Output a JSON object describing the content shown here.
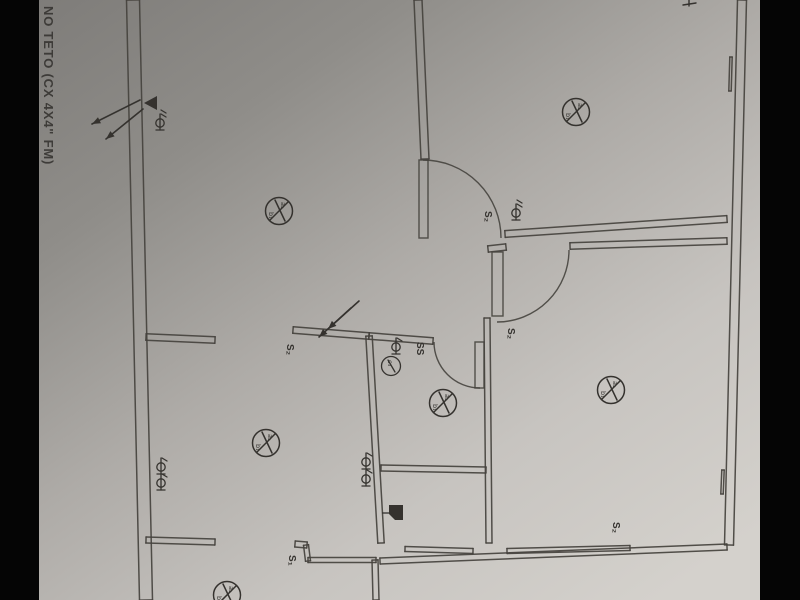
{
  "photo": {
    "note_text": "NO TETO (CX 4X4\" FM)",
    "colors": {
      "photo_edge": "#050505",
      "paper_stops": [
        "#7e7c79",
        "#8f8d89",
        "#aeaba7",
        "#c7c4c0",
        "#d4d1cc"
      ],
      "ink": "#45423e",
      "ink2": "#34322f"
    }
  },
  "plan": {
    "walls": [
      {
        "name": "left-exterior-wall",
        "s": [
          133,
          0,
          146,
          600
        ],
        "off": 6.5
      },
      {
        "name": "right-exterior-wall",
        "s": [
          742,
          0,
          729,
          545
        ],
        "off": 4.5
      },
      {
        "name": "bottom-exterior-wall",
        "s": [
          380,
          561,
          727,
          547
        ],
        "off": 3
      },
      {
        "name": "top-center-wall",
        "s": [
          418,
          0,
          425,
          159
        ],
        "off": 4
      },
      {
        "name": "mid-left-wall",
        "s": [
          146,
          337,
          215,
          340
        ],
        "off": 3.2
      },
      {
        "name": "mid-wall-a",
        "s": [
          293,
          330,
          369,
          336
        ],
        "off": 3.2
      },
      {
        "name": "mid-wall-b",
        "s": [
          369,
          336,
          433,
          341
        ],
        "off": 3.2
      },
      {
        "name": "center-vertical-wall",
        "s": [
          369,
          336,
          381,
          543
        ],
        "off": 3.2
      },
      {
        "name": "bath-bottom-wall",
        "s": [
          381,
          468,
          486,
          470
        ],
        "off": 3
      },
      {
        "name": "bath-right-wall",
        "s": [
          487,
          318,
          489,
          543
        ],
        "off": 3
      },
      {
        "name": "corridor-wall-a",
        "s": [
          505,
          234,
          727,
          219
        ],
        "off": 3.4
      },
      {
        "name": "corridor-wall-b-stub",
        "s": [
          488,
          249,
          506,
          247
        ],
        "off": 3.2
      },
      {
        "name": "corridor-wall-b",
        "s": [
          570,
          246,
          727,
          241
        ],
        "off": 3.2
      },
      {
        "name": "bottom-left-wall",
        "s": [
          146,
          540,
          215,
          542
        ],
        "off": 3
      },
      {
        "name": "bottom-jog-top",
        "s": [
          295,
          544,
          307,
          545
        ],
        "off": 3
      },
      {
        "name": "bottom-jog-vert",
        "s": [
          306,
          545,
          308,
          561
        ],
        "off": 2.5
      },
      {
        "name": "bottom-jog-horiz",
        "s": [
          308,
          560,
          376,
          560
        ],
        "off": 2.5
      },
      {
        "name": "bottom-jog-down",
        "s": [
          375,
          560,
          376,
          600
        ],
        "off": 3
      },
      {
        "name": "bottom-room-wall-1",
        "s": [
          405,
          549,
          473,
          551
        ],
        "off": 2.5
      },
      {
        "name": "bottom-room-wall-2",
        "s": [
          507,
          551,
          630,
          548
        ],
        "off": 2.5
      },
      {
        "name": "window-mark-top",
        "s": [
          731,
          57,
          730,
          91
        ],
        "off": 1.2
      },
      {
        "name": "window-mark-bottom",
        "s": [
          723,
          470,
          722,
          494
        ],
        "off": 1.2
      }
    ],
    "doors": [
      {
        "leaf": [
          419,
          160,
          9,
          78
        ],
        "arc": "M 423,160 A 78 78 0 0 1 501,238"
      },
      {
        "leaf": [
          492,
          252,
          11,
          64
        ],
        "arc": "M 569,250 A 72 72 0 0 1 497,322"
      },
      {
        "leaf": [
          475,
          342,
          9,
          46
        ],
        "arc": "M 434,342 A 46 46 0 0 0 480,388"
      }
    ],
    "ceiling_lights": [
      {
        "x": 279,
        "y": 211
      },
      {
        "x": 576,
        "y": 112
      },
      {
        "x": 266,
        "y": 443
      },
      {
        "x": 443,
        "y": 403
      },
      {
        "x": 611,
        "y": 390
      },
      {
        "x": 227,
        "y": 595
      }
    ],
    "outlets": [
      {
        "x": 160,
        "y": 123,
        "ticks": 2
      },
      {
        "x": 161,
        "y": 467,
        "ticks": 1
      },
      {
        "x": 161,
        "y": 483,
        "ticks": 1
      },
      {
        "x": 366,
        "y": 462,
        "ticks": 1
      },
      {
        "x": 366,
        "y": 479,
        "ticks": 1
      },
      {
        "x": 516,
        "y": 213,
        "ticks": 2
      },
      {
        "x": 396,
        "y": 347,
        "ticks": 1
      }
    ],
    "switches": [
      {
        "x": 291,
        "y": 349,
        "t": "S₂"
      },
      {
        "x": 489,
        "y": 216,
        "t": "S₂"
      },
      {
        "x": 512,
        "y": 333,
        "t": "S₂"
      },
      {
        "x": 293,
        "y": 560,
        "t": "S₁"
      },
      {
        "x": 617,
        "y": 527,
        "t": "S₂"
      },
      {
        "x": 421,
        "y": 347,
        "t": "SS"
      }
    ],
    "wall_lights": [
      {
        "x": 391,
        "y": 366
      }
    ],
    "arrows": [
      [
        140,
        100,
        92,
        124
      ],
      [
        143,
        109,
        106,
        139
      ],
      [
        359,
        301,
        319,
        337
      ],
      [
        351,
        308,
        328,
        329
      ]
    ],
    "triangle": {
      "points": "144,103 157,96 157,110"
    },
    "panel": {
      "x": 389,
      "y": 505,
      "w": 14,
      "h": 15
    },
    "edge_marks": [
      [
        683,
        5,
        696,
        3
      ],
      [
        689,
        0,
        689,
        6
      ]
    ]
  }
}
